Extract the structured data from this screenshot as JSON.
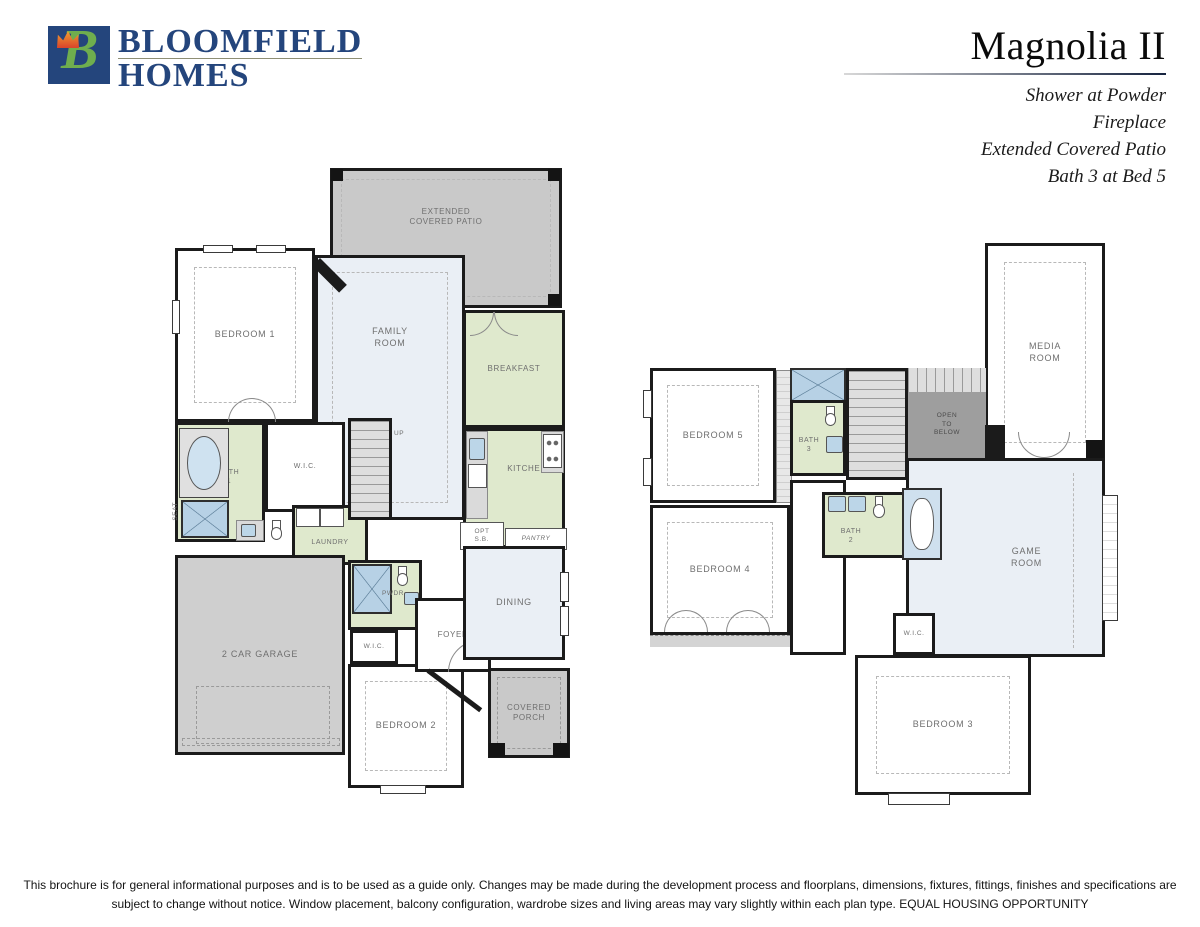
{
  "header": {
    "logo_line1": "BLOOMFIELD",
    "logo_line2": "HOMES",
    "logo_mark": "B",
    "plan_title": "Magnolia II",
    "options": [
      "Shower at Powder",
      "Fireplace",
      "Extended Covered Patio",
      "Bath 3 at Bed 5"
    ]
  },
  "floor1": {
    "patio": "EXTENDED\nCOVERED PATIO",
    "bedroom1": "BEDROOM 1",
    "family": "FAMILY\nROOM",
    "breakfast": "BREAKFAST",
    "kitchen": "KITCHEN",
    "pantry": "PANTRY",
    "opt_cab": "OPT\nS.B.",
    "bath1": "BATH\n1",
    "seat": "SEAT",
    "wic_master": "W.I.C.",
    "laundry": "LAUNDRY",
    "up": "UP",
    "pwdr": "PWDR",
    "garage": "2 CAR GARAGE",
    "wic_bed2": "W.I.C.",
    "bedroom2": "BEDROOM 2",
    "foyer": "FOYER",
    "dining": "DINING",
    "porch": "COVERED\nPORCH"
  },
  "floor2": {
    "media": "MEDIA\nROOM",
    "bedroom5": "BEDROOM 5",
    "bath3": "BATH\n3",
    "open_below": "OPEN\nTO\nBELOW",
    "dn": "DN",
    "bedroom4": "BEDROOM 4",
    "bath2": "BATH\n2",
    "gameroom": "GAME\nROOM",
    "wic": "W.I.C.",
    "bedroom3": "BEDROOM 3"
  },
  "footer": {
    "line1": "This brochure is for general informational purposes and is to be used as a guide only. Changes may be made during the development process and floorplans, dimensions, fixtures, fittings, finishes and specifications are",
    "line2": "subject to change without notice. Window placement, balcony configuration, wardrobe sizes and living areas may vary slightly within each plan type.  EQUAL HOUSING OPPORTUNITY"
  },
  "colors": {
    "brand_navy": "#24457c",
    "logo_green": "#6fae4e",
    "tulip_orange": "#e87a1e",
    "room_green": "#dfe9cd",
    "room_blue": "#eaeff5",
    "patio_gray": "#c9c9c9",
    "open_below_gray": "#9e9e9e",
    "shower_blue": "#b7d1e5",
    "wall_black": "#1b1b1b",
    "label_gray": "#6f6f6f"
  }
}
